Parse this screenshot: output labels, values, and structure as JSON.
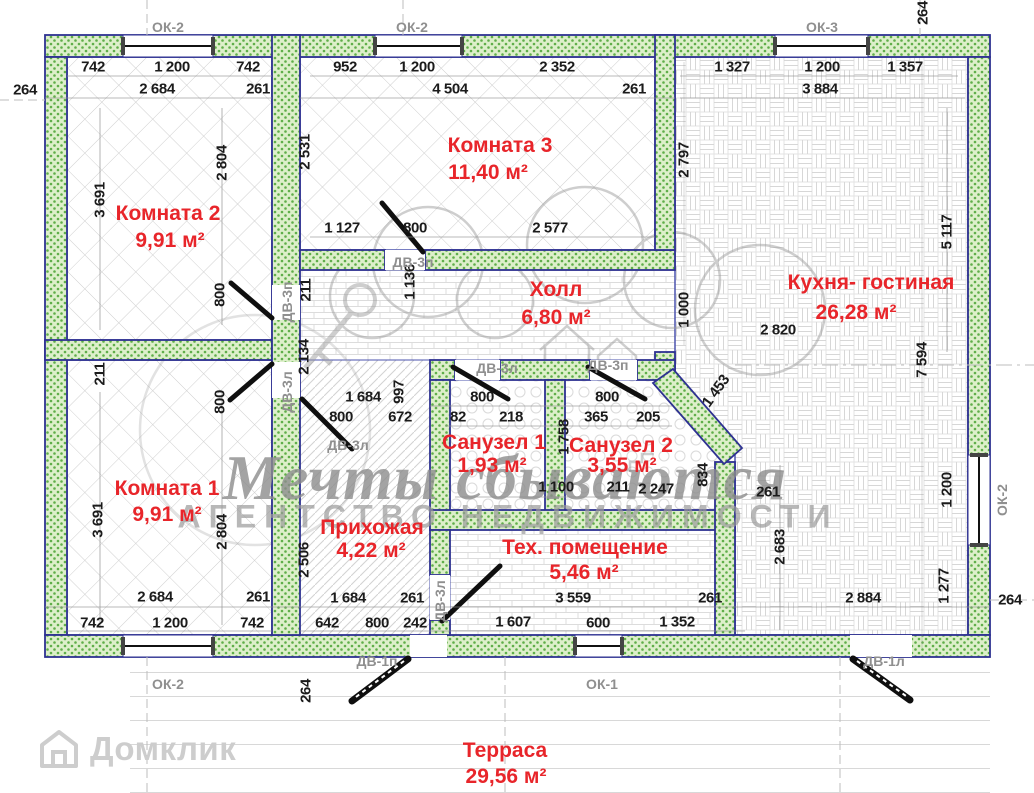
{
  "plan": {
    "title_note": "floor plan drawing",
    "watermark": {
      "script": "Мечты сбываются",
      "caps": "АГЕНТСТВО НЕДВИЖИМОСТИ",
      "brand": "Домклик"
    },
    "colors": {
      "room_label_red": "#e8252a",
      "wall_dot_green": "#5fae49",
      "wall_bg_green": "#ddefca",
      "wall_outline_navy": "#2e3192",
      "dimension_text": "#1b1b1b",
      "opening_label_gray": "#8f8f8f",
      "watermark_gray": "#9a9a9a"
    },
    "rooms": [
      {
        "name": "Комната 2",
        "area": "9,91 м²"
      },
      {
        "name": "Комната 3",
        "area": "11,40 м²"
      },
      {
        "name": "Кухня- гостиная",
        "area": "26,28 м²"
      },
      {
        "name": "Холл",
        "area": "6,80 м²"
      },
      {
        "name": "Комната 1",
        "area": "9,91 м²"
      },
      {
        "name": "Прихожая",
        "area": "4,22 м²"
      },
      {
        "name": "Санузел 1",
        "area": "1,93 м²"
      },
      {
        "name": "Санузел 2",
        "area": "3,55 м²"
      },
      {
        "name": "Тех. помещение",
        "area": "5,46 м²"
      },
      {
        "name": "Терраса",
        "area": "29,56 м²"
      }
    ],
    "windows": [
      "ОК-1",
      "ОК-2",
      "ОК-3"
    ],
    "doors": [
      "ДВ-1п",
      "ДВ-1л",
      "ДВ-3п",
      "ДВ-3л"
    ],
    "labels": [
      {
        "t": "742",
        "x": 93,
        "y": 67,
        "c": "dim"
      },
      {
        "t": "1 200",
        "x": 172,
        "y": 67,
        "c": "dim"
      },
      {
        "t": "742",
        "x": 248,
        "y": 67,
        "c": "dim"
      },
      {
        "t": "2 684",
        "x": 157,
        "y": 89,
        "c": "dim"
      },
      {
        "t": "261",
        "x": 258,
        "y": 89,
        "c": "dim"
      },
      {
        "t": "264",
        "x": 25,
        "y": 90,
        "c": "dim"
      },
      {
        "t": "3 691",
        "x": 100,
        "y": 200,
        "r": -90,
        "c": "dim"
      },
      {
        "t": "2 804",
        "x": 222,
        "y": 163,
        "r": -90,
        "c": "dim"
      },
      {
        "t": "952",
        "x": 345,
        "y": 67,
        "c": "dim"
      },
      {
        "t": "1 200",
        "x": 417,
        "y": 67,
        "c": "dim"
      },
      {
        "t": "2 352",
        "x": 557,
        "y": 67,
        "c": "dim"
      },
      {
        "t": "4 504",
        "x": 450,
        "y": 89,
        "c": "dim"
      },
      {
        "t": "261",
        "x": 634,
        "y": 89,
        "c": "dim"
      },
      {
        "t": "2 531",
        "x": 305,
        "y": 152,
        "r": -90,
        "c": "dim"
      },
      {
        "t": "1 127",
        "x": 342,
        "y": 228,
        "c": "dim"
      },
      {
        "t": "800",
        "x": 415,
        "y": 228,
        "c": "dim"
      },
      {
        "t": "2 577",
        "x": 550,
        "y": 228,
        "c": "dim"
      },
      {
        "t": "1 327",
        "x": 732,
        "y": 67,
        "c": "dim"
      },
      {
        "t": "1 200",
        "x": 822,
        "y": 67,
        "c": "dim"
      },
      {
        "t": "1 357",
        "x": 905,
        "y": 67,
        "c": "dim"
      },
      {
        "t": "3 884",
        "x": 820,
        "y": 89,
        "c": "dim"
      },
      {
        "t": "264",
        "x": 923,
        "y": 13,
        "r": -90,
        "c": "dim"
      },
      {
        "t": "2 797",
        "x": 684,
        "y": 160,
        "r": -90,
        "c": "dim"
      },
      {
        "t": "5 117",
        "x": 947,
        "y": 232,
        "r": -90,
        "c": "dim"
      },
      {
        "t": "7 594",
        "x": 922,
        "y": 360,
        "r": -90,
        "c": "dim"
      },
      {
        "t": "1 000",
        "x": 684,
        "y": 310,
        "r": -90,
        "c": "dim"
      },
      {
        "t": "1 453",
        "x": 716,
        "y": 391,
        "r": -54,
        "c": "dim"
      },
      {
        "t": "211",
        "x": 306,
        "y": 290,
        "r": -90,
        "c": "dim"
      },
      {
        "t": "1 136",
        "x": 410,
        "y": 282,
        "r": -90,
        "c": "dim"
      },
      {
        "t": "2 820",
        "x": 778,
        "y": 330,
        "c": "dim"
      },
      {
        "t": "997",
        "x": 399,
        "y": 392,
        "r": -90,
        "c": "dim"
      },
      {
        "t": "2 134",
        "x": 304,
        "y": 357,
        "r": -90,
        "c": "dim"
      },
      {
        "t": "800",
        "x": 220,
        "y": 295,
        "r": -90,
        "c": "dim"
      },
      {
        "t": "211",
        "x": 100,
        "y": 374,
        "r": -90,
        "c": "dim"
      },
      {
        "t": "800",
        "x": 220,
        "y": 402,
        "r": -90,
        "c": "dim"
      },
      {
        "t": "1 684",
        "x": 363,
        "y": 397,
        "c": "dim"
      },
      {
        "t": "800",
        "x": 341,
        "y": 417,
        "c": "dim"
      },
      {
        "t": "672",
        "x": 400,
        "y": 417,
        "c": "dim"
      },
      {
        "t": "800",
        "x": 482,
        "y": 397,
        "c": "dim"
      },
      {
        "t": "82",
        "x": 458,
        "y": 417,
        "c": "dim"
      },
      {
        "t": "218",
        "x": 511,
        "y": 417,
        "c": "dim"
      },
      {
        "t": "800",
        "x": 607,
        "y": 397,
        "c": "dim"
      },
      {
        "t": "365",
        "x": 596,
        "y": 417,
        "c": "dim"
      },
      {
        "t": "205",
        "x": 648,
        "y": 417,
        "c": "dim"
      },
      {
        "t": "1 758",
        "x": 564,
        "y": 437,
        "r": -90,
        "c": "dim"
      },
      {
        "t": "1 100",
        "x": 556,
        "y": 487,
        "c": "dim"
      },
      {
        "t": "211",
        "x": 618,
        "y": 487,
        "c": "dim"
      },
      {
        "t": "2 247",
        "x": 656,
        "y": 489,
        "c": "dim"
      },
      {
        "t": "834",
        "x": 703,
        "y": 475,
        "r": -90,
        "c": "dim"
      },
      {
        "t": "261",
        "x": 768,
        "y": 492,
        "c": "dim"
      },
      {
        "t": "2 506",
        "x": 304,
        "y": 560,
        "r": -90,
        "c": "dim"
      },
      {
        "t": "1 684",
        "x": 348,
        "y": 598,
        "c": "dim"
      },
      {
        "t": "261",
        "x": 412,
        "y": 598,
        "c": "dim"
      },
      {
        "t": "642",
        "x": 327,
        "y": 623,
        "c": "dim"
      },
      {
        "t": "800",
        "x": 377,
        "y": 623,
        "c": "dim"
      },
      {
        "t": "242",
        "x": 415,
        "y": 623,
        "c": "dim"
      },
      {
        "t": "3 559",
        "x": 573,
        "y": 598,
        "c": "dim"
      },
      {
        "t": "261",
        "x": 710,
        "y": 598,
        "c": "dim"
      },
      {
        "t": "1 607",
        "x": 513,
        "y": 622,
        "c": "dim"
      },
      {
        "t": "600",
        "x": 598,
        "y": 623,
        "c": "dim"
      },
      {
        "t": "1 352",
        "x": 677,
        "y": 622,
        "c": "dim"
      },
      {
        "t": "2 683",
        "x": 780,
        "y": 547,
        "r": -90,
        "c": "dim"
      },
      {
        "t": "2 884",
        "x": 863,
        "y": 598,
        "c": "dim"
      },
      {
        "t": "1 200",
        "x": 947,
        "y": 490,
        "r": -90,
        "c": "dim"
      },
      {
        "t": "1 277",
        "x": 944,
        "y": 586,
        "r": -90,
        "c": "dim"
      },
      {
        "t": "264",
        "x": 1010,
        "y": 600,
        "c": "dim"
      },
      {
        "t": "3 691",
        "x": 98,
        "y": 520,
        "r": -90,
        "c": "dim"
      },
      {
        "t": "2 804",
        "x": 222,
        "y": 532,
        "r": -90,
        "c": "dim"
      },
      {
        "t": "2 684",
        "x": 155,
        "y": 597,
        "c": "dim"
      },
      {
        "t": "261",
        "x": 258,
        "y": 597,
        "c": "dim"
      },
      {
        "t": "742",
        "x": 92,
        "y": 623,
        "c": "dim"
      },
      {
        "t": "1 200",
        "x": 170,
        "y": 623,
        "c": "dim"
      },
      {
        "t": "742",
        "x": 252,
        "y": 623,
        "c": "dim"
      },
      {
        "t": "264",
        "x": 306,
        "y": 691,
        "r": -90,
        "c": "dim"
      },
      {
        "t": "ОК-2",
        "x": 168,
        "y": 27,
        "c": "tag"
      },
      {
        "t": "ОК-2",
        "x": 412,
        "y": 27,
        "c": "tag"
      },
      {
        "t": "ОК-3",
        "x": 822,
        "y": 27,
        "c": "tag"
      },
      {
        "t": "ОК-2",
        "x": 168,
        "y": 684,
        "c": "tag"
      },
      {
        "t": "ОК-1",
        "x": 602,
        "y": 684,
        "c": "tag"
      },
      {
        "t": "ОК-2",
        "x": 1002,
        "y": 500,
        "r": -90,
        "c": "tag"
      },
      {
        "t": "ДВ-3п",
        "x": 413,
        "y": 262,
        "c": "tag"
      },
      {
        "t": "ДВ-3п",
        "x": 287,
        "y": 302,
        "r": -90,
        "c": "tag"
      },
      {
        "t": "ДВ-3л",
        "x": 287,
        "y": 392,
        "r": -90,
        "c": "tag"
      },
      {
        "t": "ДВ-3л",
        "x": 348,
        "y": 445,
        "c": "tag"
      },
      {
        "t": "ДВ-3л",
        "x": 497,
        "y": 368,
        "c": "tag"
      },
      {
        "t": "ДВ-3п",
        "x": 608,
        "y": 365,
        "c": "tag"
      },
      {
        "t": "ДВ-3л",
        "x": 440,
        "y": 601,
        "r": -90,
        "c": "tag"
      },
      {
        "t": "ДВ-1п",
        "x": 377,
        "y": 661,
        "c": "tag"
      },
      {
        "t": "ДВ-1л",
        "x": 884,
        "y": 661,
        "c": "tag"
      },
      {
        "t": "Комната 2",
        "x": 168,
        "y": 214,
        "c": "room"
      },
      {
        "t": "9,91 м²",
        "x": 170,
        "y": 241,
        "c": "room"
      },
      {
        "t": "Комната 3",
        "x": 500,
        "y": 146,
        "c": "room"
      },
      {
        "t": "11,40 м²",
        "x": 488,
        "y": 173,
        "c": "room"
      },
      {
        "t": "Холл",
        "x": 556,
        "y": 290,
        "c": "room"
      },
      {
        "t": "6,80 м²",
        "x": 556,
        "y": 318,
        "c": "room"
      },
      {
        "t": "Кухня- гостиная",
        "x": 871,
        "y": 283,
        "c": "room"
      },
      {
        "t": "26,28 м²",
        "x": 856,
        "y": 313,
        "c": "room"
      },
      {
        "t": "Комната 1",
        "x": 167,
        "y": 489,
        "c": "room"
      },
      {
        "t": "9,91 м²",
        "x": 167,
        "y": 515,
        "c": "room"
      },
      {
        "t": "Прихожая",
        "x": 372,
        "y": 528,
        "c": "room"
      },
      {
        "t": "4,22 м²",
        "x": 371,
        "y": 551,
        "c": "room"
      },
      {
        "t": "Санузел 1",
        "x": 494,
        "y": 443,
        "c": "room"
      },
      {
        "t": "1,93 м²",
        "x": 492,
        "y": 466,
        "c": "room"
      },
      {
        "t": "Санузел 2",
        "x": 621,
        "y": 446,
        "c": "room"
      },
      {
        "t": "3,55 м²",
        "x": 622,
        "y": 466,
        "c": "room"
      },
      {
        "t": "Тех. помещение",
        "x": 585,
        "y": 548,
        "c": "room"
      },
      {
        "t": "5,46 м²",
        "x": 584,
        "y": 573,
        "c": "room"
      },
      {
        "t": "Терраса",
        "x": 505,
        "y": 751,
        "c": "room"
      },
      {
        "t": "29,56 м²",
        "x": 506,
        "y": 777,
        "c": "room"
      }
    ]
  }
}
